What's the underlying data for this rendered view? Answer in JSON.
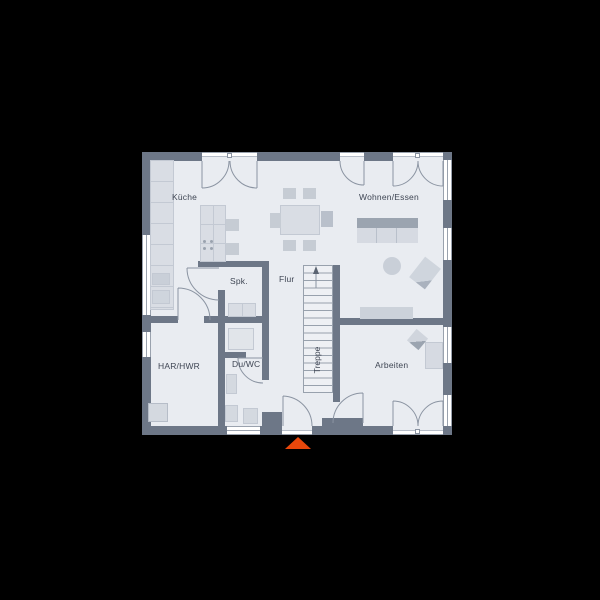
{
  "scene": {
    "type": "floor-plan",
    "background": "#000000"
  },
  "floorplan": {
    "rooms": [
      {
        "id": "kueche",
        "label": "Küche"
      },
      {
        "id": "wohnen-essen",
        "label": "Wohnen/Essen"
      },
      {
        "id": "spk",
        "label": "Spk."
      },
      {
        "id": "flur",
        "label": "Flur"
      },
      {
        "id": "treppe",
        "label": "Treppe"
      },
      {
        "id": "har-hwr",
        "label": "HAR/HWR"
      },
      {
        "id": "du-wc",
        "label": "Du/WC"
      },
      {
        "id": "arbeiten",
        "label": "Arbeiten"
      }
    ],
    "colors": {
      "background": "#000000",
      "wall": "#6d7787",
      "floor": "#e9ecf1",
      "window": "#ffffff",
      "door_arc": "#8b94a2",
      "furniture_light": "#d9dde4",
      "furniture_mid": "#c3c9d3",
      "furniture_dark": "#9ba4b0",
      "label_text": "#3f4654",
      "entrance_marker": "#e8470b"
    },
    "entrance_marker": {
      "shape": "triangle-up",
      "color": "#e8470b"
    }
  }
}
